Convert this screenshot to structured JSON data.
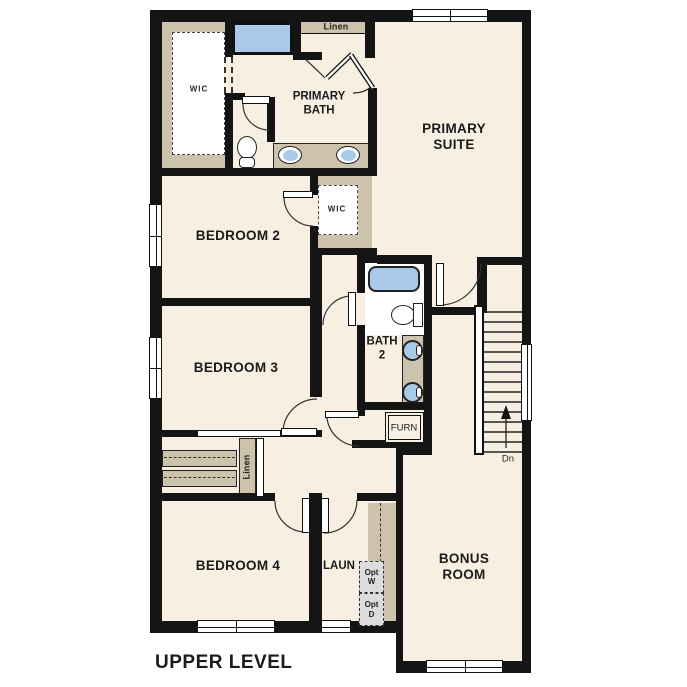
{
  "plan_title": "UPPER LEVEL",
  "colors": {
    "wall": "#141414",
    "floor": "#f7f0e2",
    "closet_tan": "#cdc2ab",
    "fixture_blue": "#a8c9e8",
    "opt_box_gray": "#dcdcdc"
  },
  "rooms": {
    "primary_suite": "PRIMARY\nSUITE",
    "primary_bath": "PRIMARY\nBATH",
    "primary_wic": "WIC",
    "linen_upper": "Linen",
    "bedroom2": "BEDROOM 2",
    "bedroom2_wic": "WIC",
    "bedroom3": "BEDROOM 3",
    "bath2": "BATH\n2",
    "furnace": "FURN",
    "linen_hall": "Linen",
    "bedroom4": "BEDROOM 4",
    "laundry": "LAUN",
    "opt_washer": "Opt\nW",
    "opt_dryer": "Opt\nD",
    "bonus_room": "BONUS\nROOM",
    "stairs_down": "Dn"
  }
}
